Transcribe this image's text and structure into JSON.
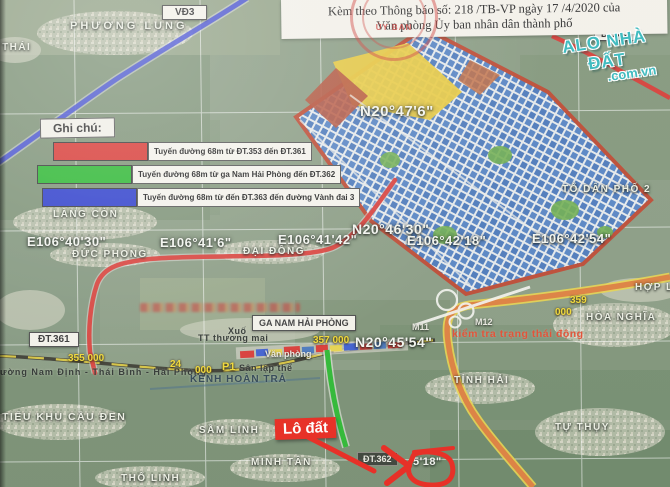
{
  "header": {
    "line1": "Kèm theo Thông báo số: 218 /TB-VP ngày 17 /4/2020 của",
    "line2": "Văn phòng Ủy ban nhân dân thành phố",
    "stamp": "ỦY BAN"
  },
  "watermark": {
    "brand": "ALO NHÀ ĐẤT",
    "domain": ".com.vn",
    "color": "#35b8bc"
  },
  "legend": {
    "title": "Ghi chú:",
    "items": [
      {
        "color": "#d93a35",
        "label": "Tuyến đường 68m từ ĐT.353 đến ĐT.361"
      },
      {
        "color": "#2db832",
        "label": "Tuyến đường 68m từ ga Nam Hải Phòng đến ĐT.362"
      },
      {
        "color": "#2f3fcc",
        "label": "Tuyến đường 68m từ đến ĐT.363 đến đường Vành đai 3"
      }
    ]
  },
  "grid": {
    "lon_labels": [
      "E106°40'30\"",
      "E106°41'6\"",
      "E106°41'42\"",
      "E106°42'18\"",
      "E106°42'54\""
    ],
    "lat_labels": [
      "N20°47'6\"",
      "N20°46'30\"",
      "N20°45'54\""
    ],
    "partial_lat": "5'18\""
  },
  "road_boxes": {
    "vd3": "VĐ3",
    "dt353": "ĐT.353",
    "dt361": "ĐT.361",
    "dt362": "ĐT.362"
  },
  "station_box": "GA NAM HẢI PHÒNG",
  "places": {
    "thai": "THÁI",
    "phuong_lung": "PHƯƠNG LUNG",
    "to_dan_pho_2": "TỔ DÂN PHỐ 2",
    "lang_con": "LÀNG CÒN",
    "duc_phong": "ĐỨC PHONG",
    "dai_dong": "ĐẠI ĐỒNG",
    "hop_l": "HỢP L",
    "hoa_nghia": "HÒA NGHĨA",
    "tinh_hai": "TỈNH HẢI",
    "tu_thuy": "TỰ THỤY",
    "sam_linh": "SẦM LINH",
    "minh_tan": "MINH TÂN",
    "tho_linh": "THỔ LINH",
    "tieu_khu_cau_den": "TIỂU KHU CẦU ĐEN",
    "kenh_hoan_tra": "KÊNH HOÀN TRẢ"
  },
  "site_notes": {
    "xuo": "Xuố",
    "tt_thuong_mai": "TT thương mại",
    "van_phong": "Văn phòng",
    "san_lap_the": "Sân lập thể",
    "m11": "M11",
    "m12": "M12",
    "red_note": "kiểm tra trạng thái động",
    "lo_dat": "Lô đất",
    "railway_name": "ường Nam Định - Thái Bình - Hải Phòng"
  },
  "km_labels": {
    "k355": "355 000",
    "k24": "24",
    "k24b": "000",
    "p1": "P1",
    "k357": "357 000",
    "k359": "359",
    "k359b": "000"
  }
}
